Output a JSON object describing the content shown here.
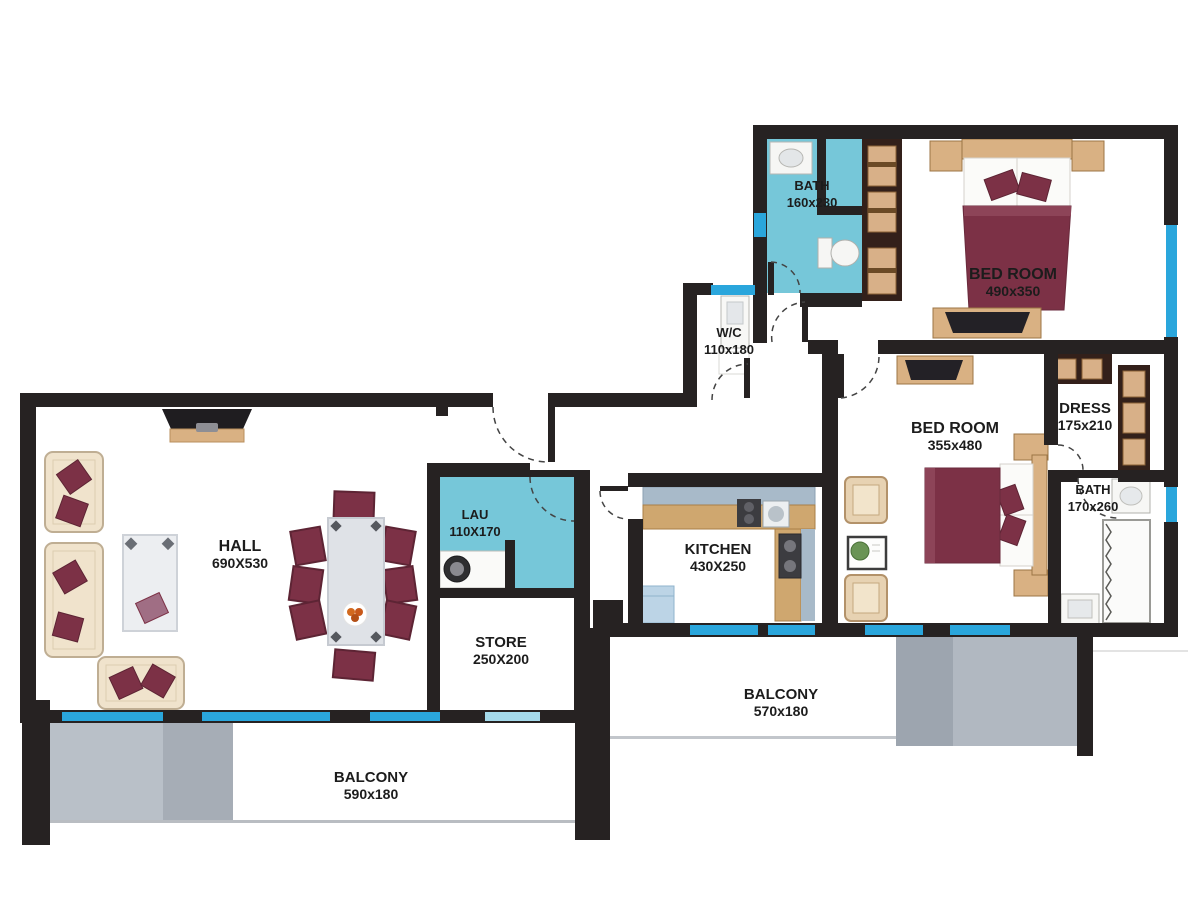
{
  "rooms": [
    {
      "id": "hall",
      "name": "HALL",
      "dims": "690X530"
    },
    {
      "id": "bedroom-1",
      "name": "BED ROOM",
      "dims": "490x350"
    },
    {
      "id": "bath-1",
      "name": "BATH",
      "dims": "160x230"
    },
    {
      "id": "wc",
      "name": "W/C",
      "dims": "110x180"
    },
    {
      "id": "bedroom-2",
      "name": "BED ROOM",
      "dims": "355x480"
    },
    {
      "id": "dress",
      "name": "DRESS",
      "dims": "175x210"
    },
    {
      "id": "bath-2",
      "name": "BATH",
      "dims": "170x260"
    },
    {
      "id": "kitchen",
      "name": "KITCHEN",
      "dims": "430X250"
    },
    {
      "id": "laundry",
      "name": "LAU",
      "dims": "110X170"
    },
    {
      "id": "store",
      "name": "STORE",
      "dims": "250X200"
    },
    {
      "id": "balcony-right",
      "name": "BALCONY",
      "dims": "570x180"
    },
    {
      "id": "balcony-left",
      "name": "BALCONY",
      "dims": "590x180"
    }
  ],
  "colors": {
    "wall": "#262222",
    "wet_room_fill": "#76c7d9",
    "window": "#2aa6dc",
    "window_light": "#a5daeb",
    "balcony_floor_dark": "#a4abb5",
    "balcony_floor_light": "#b9c0c8",
    "furniture_maroon": "#7c3146",
    "furniture_wood": "#d9b183",
    "furniture_dark_wood": "#33201a",
    "sofa_beige": "#f0e3cc",
    "counter_gray": "#a8bac9"
  }
}
